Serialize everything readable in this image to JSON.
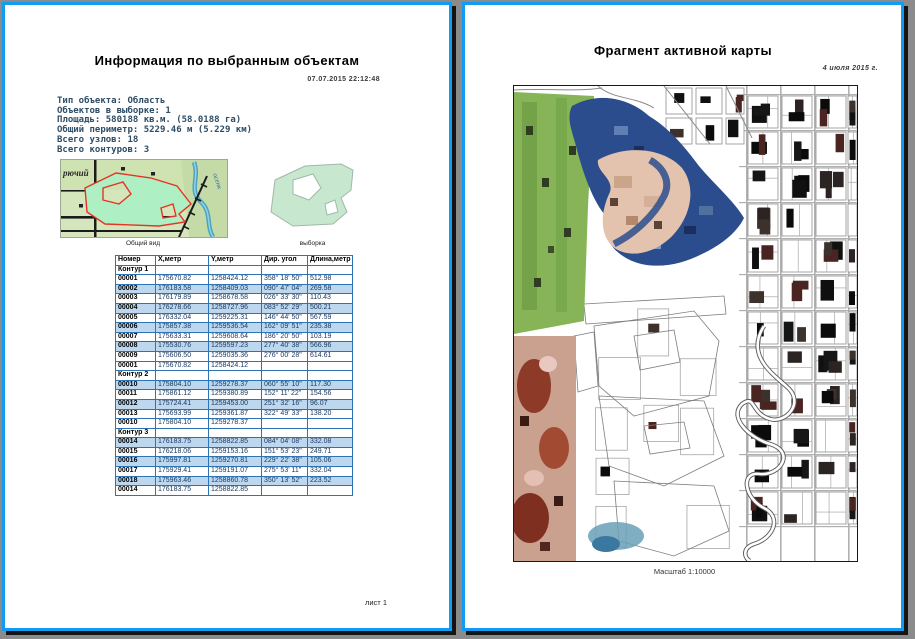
{
  "left_page": {
    "title": "Информация по выбранным объектам",
    "timestamp": "07.07.2015  22:12:48",
    "info_lines": [
      "Тип объекта: Область",
      "Объектов в выборке: 1",
      "Площадь: 580188 кв.м. (58.0188 га)",
      "Общий периметр: 5229.46 м (5.229 км)",
      "Всего узлов: 18",
      "Всего контуров: 3"
    ],
    "thumbnails": {
      "overview_label": "Общий вид",
      "selection_label": "выборка",
      "map_text_settlement": "рючий",
      "map_text_river": "осенк"
    },
    "table": {
      "headers": [
        "Номер",
        "X,метр",
        "Y,метр",
        "Дир. угол",
        "Длина,метр"
      ],
      "rows": [
        {
          "type": "section",
          "cells": [
            "Контур 1",
            "",
            "",
            "",
            ""
          ]
        },
        {
          "shaded": false,
          "cells": [
            "00001",
            "175670.82",
            "1258424.12",
            "358° 18' 50\"",
            "512.98"
          ]
        },
        {
          "shaded": true,
          "cells": [
            "00002",
            "176183.58",
            "1258409.03",
            "090° 47' 04\"",
            "269.58"
          ]
        },
        {
          "shaded": false,
          "cells": [
            "00003",
            "176179.89",
            "1258678.58",
            "026° 33' 30\"",
            "110.43"
          ]
        },
        {
          "shaded": true,
          "cells": [
            "00004",
            "176278.66",
            "1258727.96",
            "083° 52' 29\"",
            "500.21"
          ]
        },
        {
          "shaded": false,
          "cells": [
            "00005",
            "176332.04",
            "1259225.31",
            "146° 44' 50\"",
            "567.59"
          ]
        },
        {
          "shaded": true,
          "cells": [
            "00006",
            "175857.38",
            "1259536.54",
            "162° 09' 51\"",
            "235.38"
          ]
        },
        {
          "shaded": false,
          "cells": [
            "00007",
            "175633.31",
            "1259608.64",
            "186° 20' 50\"",
            "103.19"
          ]
        },
        {
          "shaded": true,
          "cells": [
            "00008",
            "175530.76",
            "1259597.23",
            "277° 40' 38\"",
            "566.96"
          ]
        },
        {
          "shaded": false,
          "cells": [
            "00009",
            "175606.50",
            "1259035.36",
            "276° 00' 28\"",
            "614.61"
          ]
        },
        {
          "shaded": false,
          "cells": [
            "00001",
            "175670.82",
            "1258424.12",
            "",
            ""
          ]
        },
        {
          "type": "section",
          "cells": [
            "Контур 2",
            "",
            "",
            "",
            ""
          ]
        },
        {
          "shaded": true,
          "cells": [
            "00010",
            "175804.10",
            "1259278.37",
            "060° 55' 10\"",
            "117.30"
          ]
        },
        {
          "shaded": false,
          "cells": [
            "00011",
            "175861.12",
            "1259380.89",
            "152° 11' 22\"",
            "154.56"
          ]
        },
        {
          "shaded": true,
          "cells": [
            "00012",
            "175724.41",
            "1259453.00",
            "251° 32' 16\"",
            "96.07"
          ]
        },
        {
          "shaded": false,
          "cells": [
            "00013",
            "175693.99",
            "1259361.87",
            "322° 49' 33\"",
            "138.20"
          ]
        },
        {
          "shaded": false,
          "cells": [
            "00010",
            "175804.10",
            "1259278.37",
            "",
            ""
          ]
        },
        {
          "type": "section",
          "cells": [
            "Контур 3",
            "",
            "",
            "",
            ""
          ]
        },
        {
          "shaded": true,
          "cells": [
            "00014",
            "176183.75",
            "1258822.85",
            "084° 04' 08\"",
            "332.08"
          ]
        },
        {
          "shaded": false,
          "cells": [
            "00015",
            "176218.06",
            "1259153.16",
            "151° 53' 23\"",
            "249.71"
          ]
        },
        {
          "shaded": true,
          "cells": [
            "00016",
            "175997.81",
            "1259270.81",
            "229° 22' 38\"",
            "105.06"
          ]
        },
        {
          "shaded": false,
          "cells": [
            "00017",
            "175929.41",
            "1259191.07",
            "275° 53' 11\"",
            "332.04"
          ]
        },
        {
          "shaded": true,
          "cells": [
            "00018",
            "175963.46",
            "1258860.78",
            "350° 13' 52\"",
            "223.52"
          ]
        },
        {
          "shaded": false,
          "cells": [
            "00014",
            "176183.75",
            "1258822.85",
            "",
            ""
          ]
        }
      ]
    },
    "footer": "лист 1"
  },
  "right_page": {
    "title": "Фрагмент активной карты",
    "date": "4 июля 2015 г.",
    "caption": "Масштаб 1:10000"
  },
  "colors": {
    "page_border": "#129bf3",
    "background": "#8b8b8b",
    "table_border": "#2e74b5",
    "row_stripe": "#bdd7ee",
    "selection_fill": "#c7e7cf",
    "area_outline_red": "#e43425"
  }
}
